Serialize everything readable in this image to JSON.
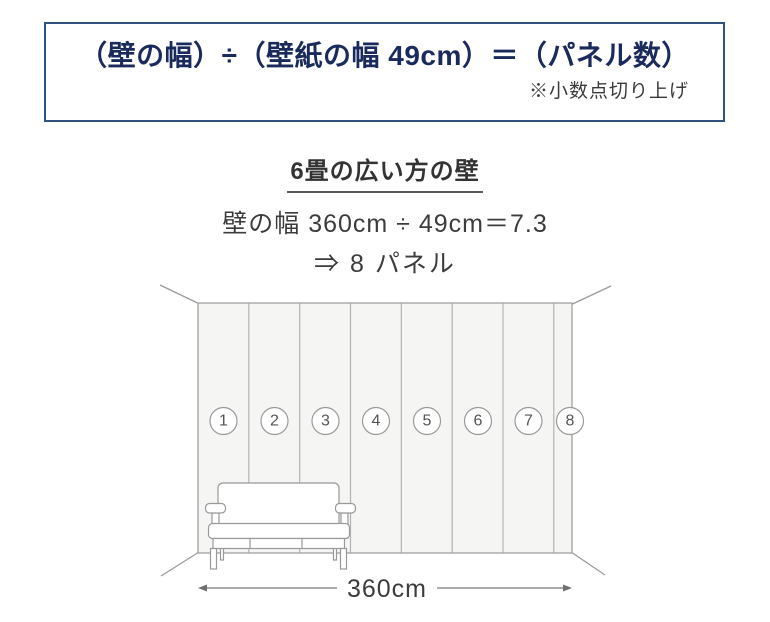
{
  "formula_box": {
    "formula": "（壁の幅）÷（壁紙の幅 49cm）＝（パネル数）",
    "note": "※小数点切り上げ"
  },
  "example": {
    "heading": "6畳の広い方の壁",
    "calculation": "壁の幅 360cm ÷ 49cm＝7.3",
    "result": "⇒ 8 パネル"
  },
  "diagram": {
    "panel_numbers": [
      "1",
      "2",
      "3",
      "4",
      "5",
      "6",
      "7",
      "8"
    ],
    "wall_width_label": "360cm"
  },
  "colors": {
    "formula_text": "#1a2a5c",
    "box_border": "#31517e",
    "body_text": "#3c3c3c",
    "line_gray": "#9a9a9a",
    "panel_fill": "#f5f5f3"
  }
}
